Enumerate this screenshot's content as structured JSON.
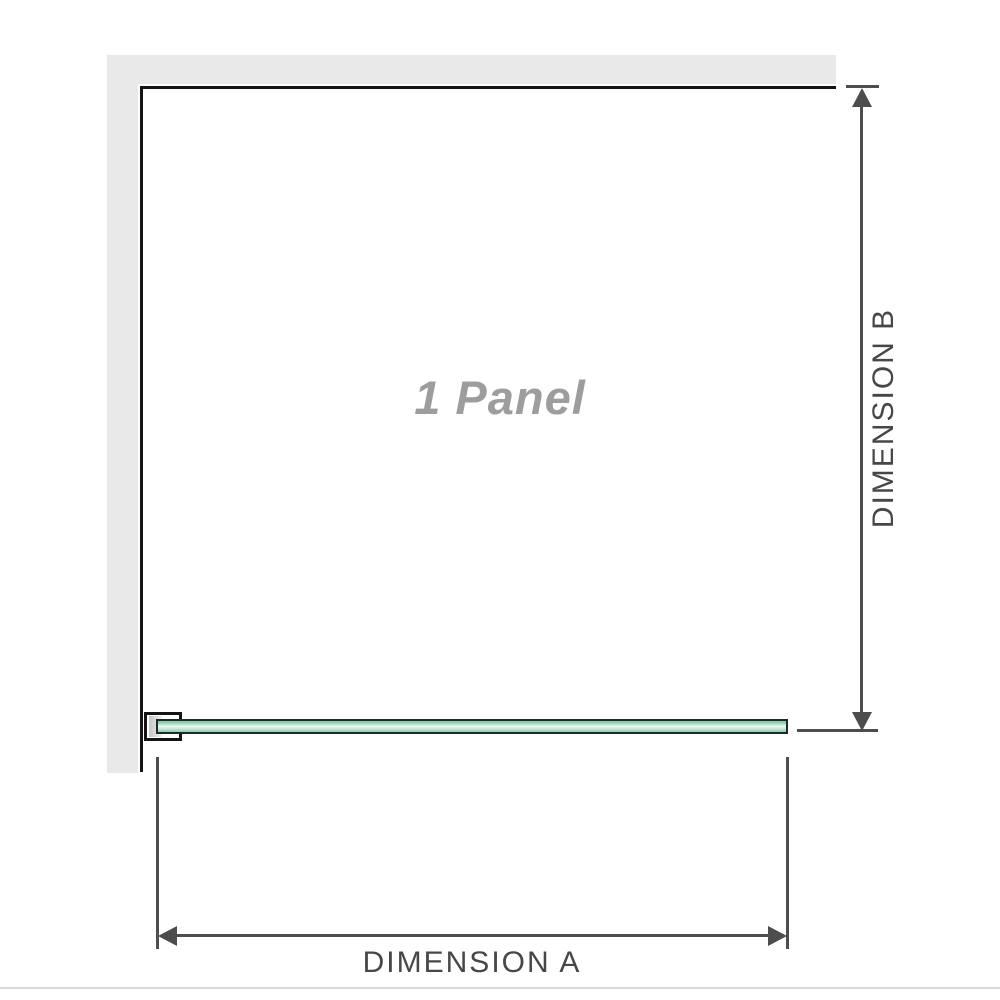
{
  "diagram": {
    "panel_label": "1 Panel",
    "dimension_a_label": "DIMENSION A",
    "dimension_b_label": "DIMENSION B"
  },
  "colors": {
    "wall_gray": "#e9e9e9",
    "outline_black": "#141414",
    "dim_gray": "#4d4d4d",
    "label_gray": "#474747",
    "panel_text_gray": "#9d9d9d",
    "glass_border": "#1e2b25",
    "glass_top": "#7fc4a4",
    "glass_mid": "#e9f7f0",
    "glass_low": "#a9dbc5",
    "bracket_fill": "#ffffff",
    "bracket_inner": "#c6c6c6",
    "baseline_gray": "#d9d9d9",
    "bg": "#ffffff"
  }
}
